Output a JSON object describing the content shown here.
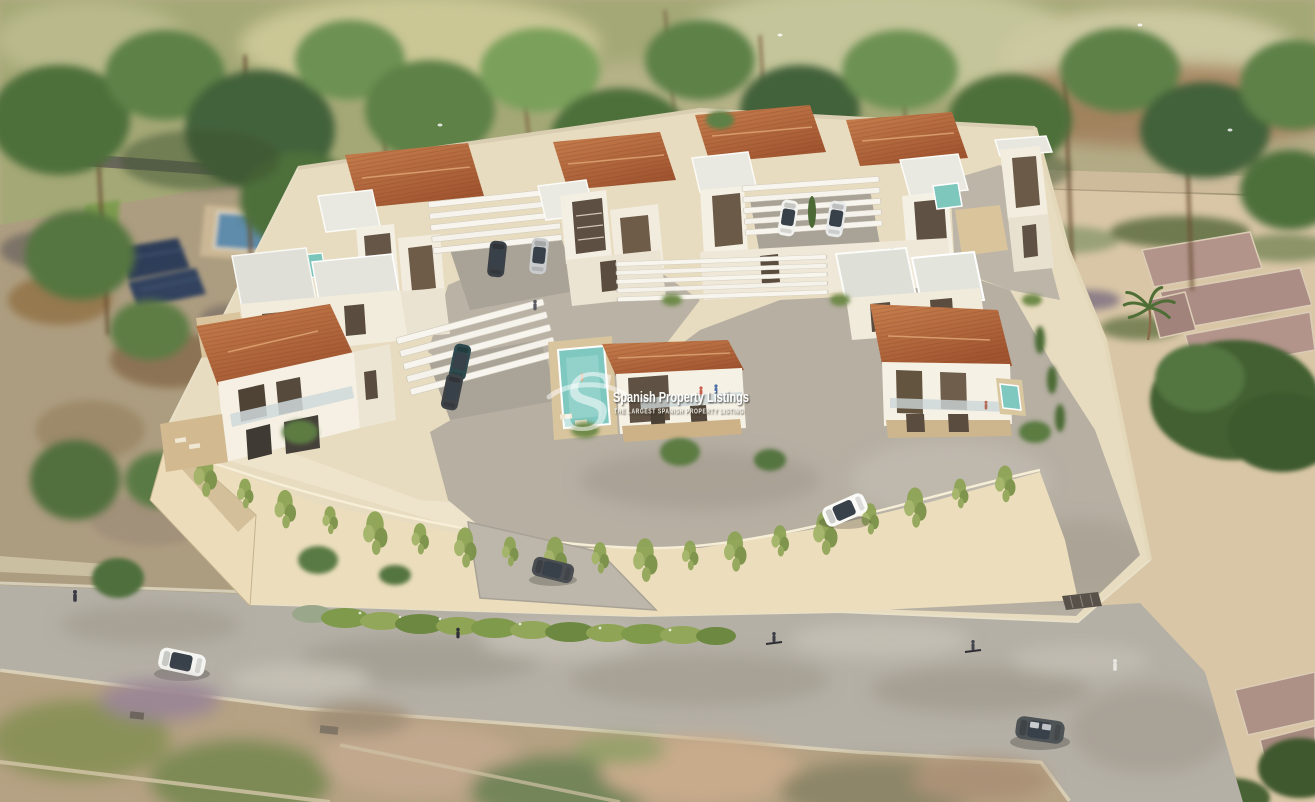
{
  "watermark": {
    "logo_letter": "S",
    "title": "Spanish Property Listings",
    "tagline": "THE LARGEST SPANISH PROPERTY LISTING"
  },
  "scene": {
    "type": "aerial-architectural-render",
    "description": "Bird's-eye 3D visualisation of a new gated development of modern two-storey white villas with terracotta hip roofs, flat-roof towers, white pergola carports, private pools and a vine-covered beige perimeter retaining wall, bordered by a curving road, pine and palm trees, sandy scrubland with stone ruins, and neighbouring plots.",
    "development": {
      "villa_clusters": 7,
      "pools_visible": 4,
      "pergola_carports": 4,
      "perimeter": "beige retaining wall with hanging green vines",
      "entrance_gate": "bottom-right of plot"
    },
    "vehicles": [
      {
        "type": "van",
        "color": "white",
        "location": "street-left"
      },
      {
        "type": "estate-car",
        "color": "dark-grey",
        "location": "entrance-ramp"
      },
      {
        "type": "suv",
        "color": "white",
        "location": "inner-driveway"
      },
      {
        "type": "minivan",
        "color": "dark-grey",
        "location": "street-bottom-right"
      },
      {
        "type": "suv",
        "color": "dark-grey",
        "location": "front-carport"
      },
      {
        "type": "sedan",
        "color": "dark-teal",
        "location": "front-carport"
      },
      {
        "type": "suv",
        "color": "dark-grey",
        "location": "back-left-carport"
      },
      {
        "type": "sedan",
        "color": "silver",
        "location": "back-left-carport"
      },
      {
        "type": "suv",
        "color": "white",
        "location": "back-right-carport"
      },
      {
        "type": "sedan",
        "color": "white",
        "location": "back-right-carport"
      }
    ],
    "people": [
      "pedestrian-on-left-road",
      "person-on-inner-street",
      "two-people-on-middle-villa-balcony",
      "swimmer-in-middle-pool",
      "cyclist-on-road",
      "second-cyclist-on-road",
      "pedestrian-at-entrance-gate",
      "person-on-back-left-balcony"
    ],
    "environment": [
      "pine-trees",
      "palm-trees",
      "sandy-dunes-with-scrub",
      "stone-ruins-right",
      "neighbour-plot-with-pool-and-solar-panels",
      "flowering-hedge-along-road",
      "aerial-photo-ground-below-road"
    ]
  },
  "palette": {
    "terracotta_roof": "#b4683f",
    "white_walls": "#f5f0e4",
    "flat_roof": "#e2e2da",
    "platform_sand": "#e8dcc0",
    "dune_sand": "#d9c6a6",
    "road_grey": "#b5b0a6",
    "pool_teal": "#7fc8c0",
    "foliage_green": "#5d7f48",
    "vine_green": "#8ea455",
    "wall_beige": "#ecdebc"
  }
}
